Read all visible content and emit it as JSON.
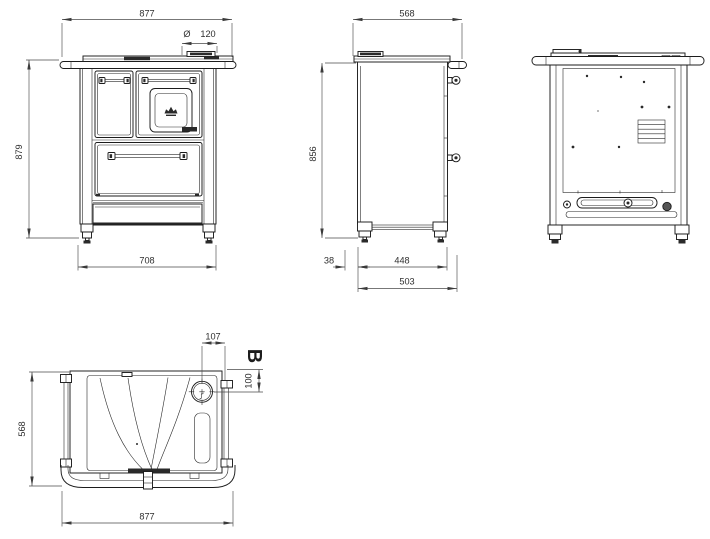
{
  "drawing_dimensions": {
    "front_width_top": "877",
    "front_flue_symbol": "Ø",
    "front_flue_diameter": "120",
    "front_height": "879",
    "front_width_bottom": "708",
    "side_depth_top": "568",
    "side_height": "856",
    "side_back_offset": "38",
    "side_leg_span": "448",
    "side_depth_bottom": "503",
    "top_flue_offset_x": "107",
    "top_section_label": "B",
    "top_flue_offset_y": "100",
    "top_depth": "568",
    "top_width": "877"
  }
}
